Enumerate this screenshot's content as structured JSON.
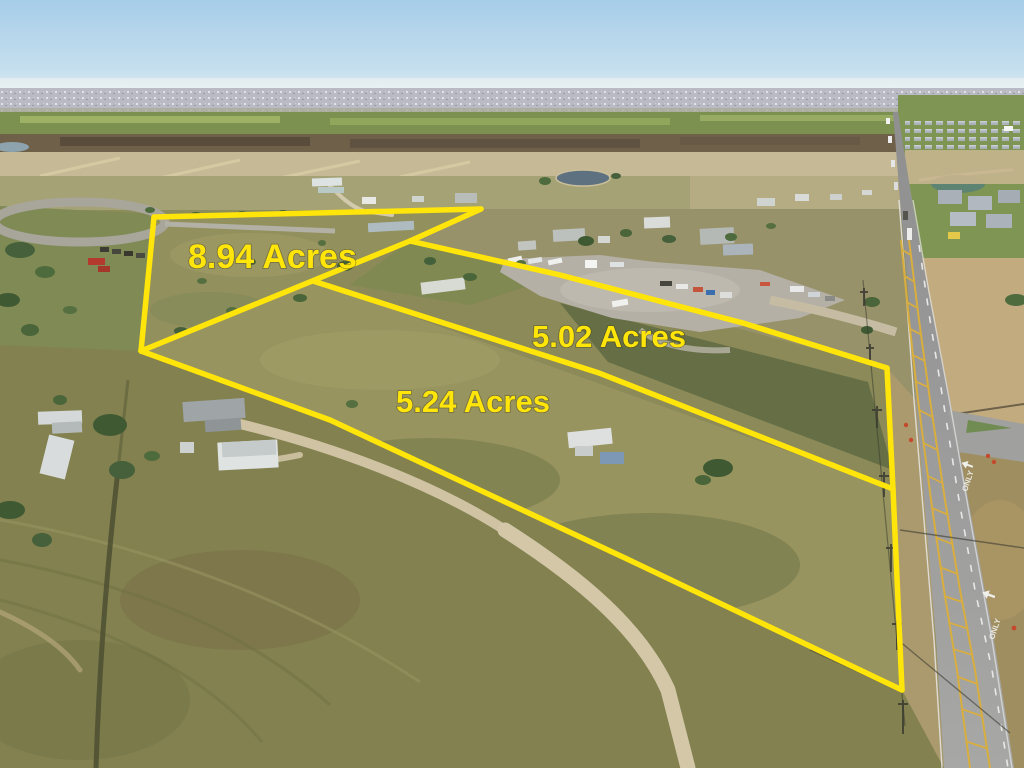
{
  "photo": {
    "kind": "aerial-drone-photo",
    "subject": "rural acreage with surveyed parcel outlines"
  },
  "overlay": {
    "color": "#ffe50a",
    "stroke_width": 5.5,
    "parcels": [
      {
        "name": "parcel-8-94",
        "label": "8.94 Acres",
        "label_x": 188,
        "label_y": 268,
        "font_size": 34
      },
      {
        "name": "parcel-5-02",
        "label": "5.02 Acres",
        "label_x": 532,
        "label_y": 347,
        "font_size": 31
      },
      {
        "name": "parcel-5-24",
        "label": "5.24 Acres",
        "label_x": 396,
        "label_y": 412,
        "font_size": 31
      }
    ],
    "lines": [
      {
        "name": "top-edge",
        "points": "154,217 481,209"
      },
      {
        "name": "left-edge",
        "points": "154,217 141,351"
      },
      {
        "name": "notch-edge",
        "points": "481,209 410,241"
      },
      {
        "name": "shared-edge-a",
        "points": "410,241 141,351"
      },
      {
        "name": "line-b",
        "points": "410,241 560,275 743,323 887,368"
      },
      {
        "name": "right-edge",
        "points": "887,368 893,489 902,690"
      },
      {
        "name": "mid-boundary",
        "points": "313,281 599,373 893,489"
      },
      {
        "name": "bottom-edge",
        "points": "141,351 330,420 625,558 902,690"
      }
    ]
  },
  "road": {
    "only_marking": "ONLY"
  }
}
